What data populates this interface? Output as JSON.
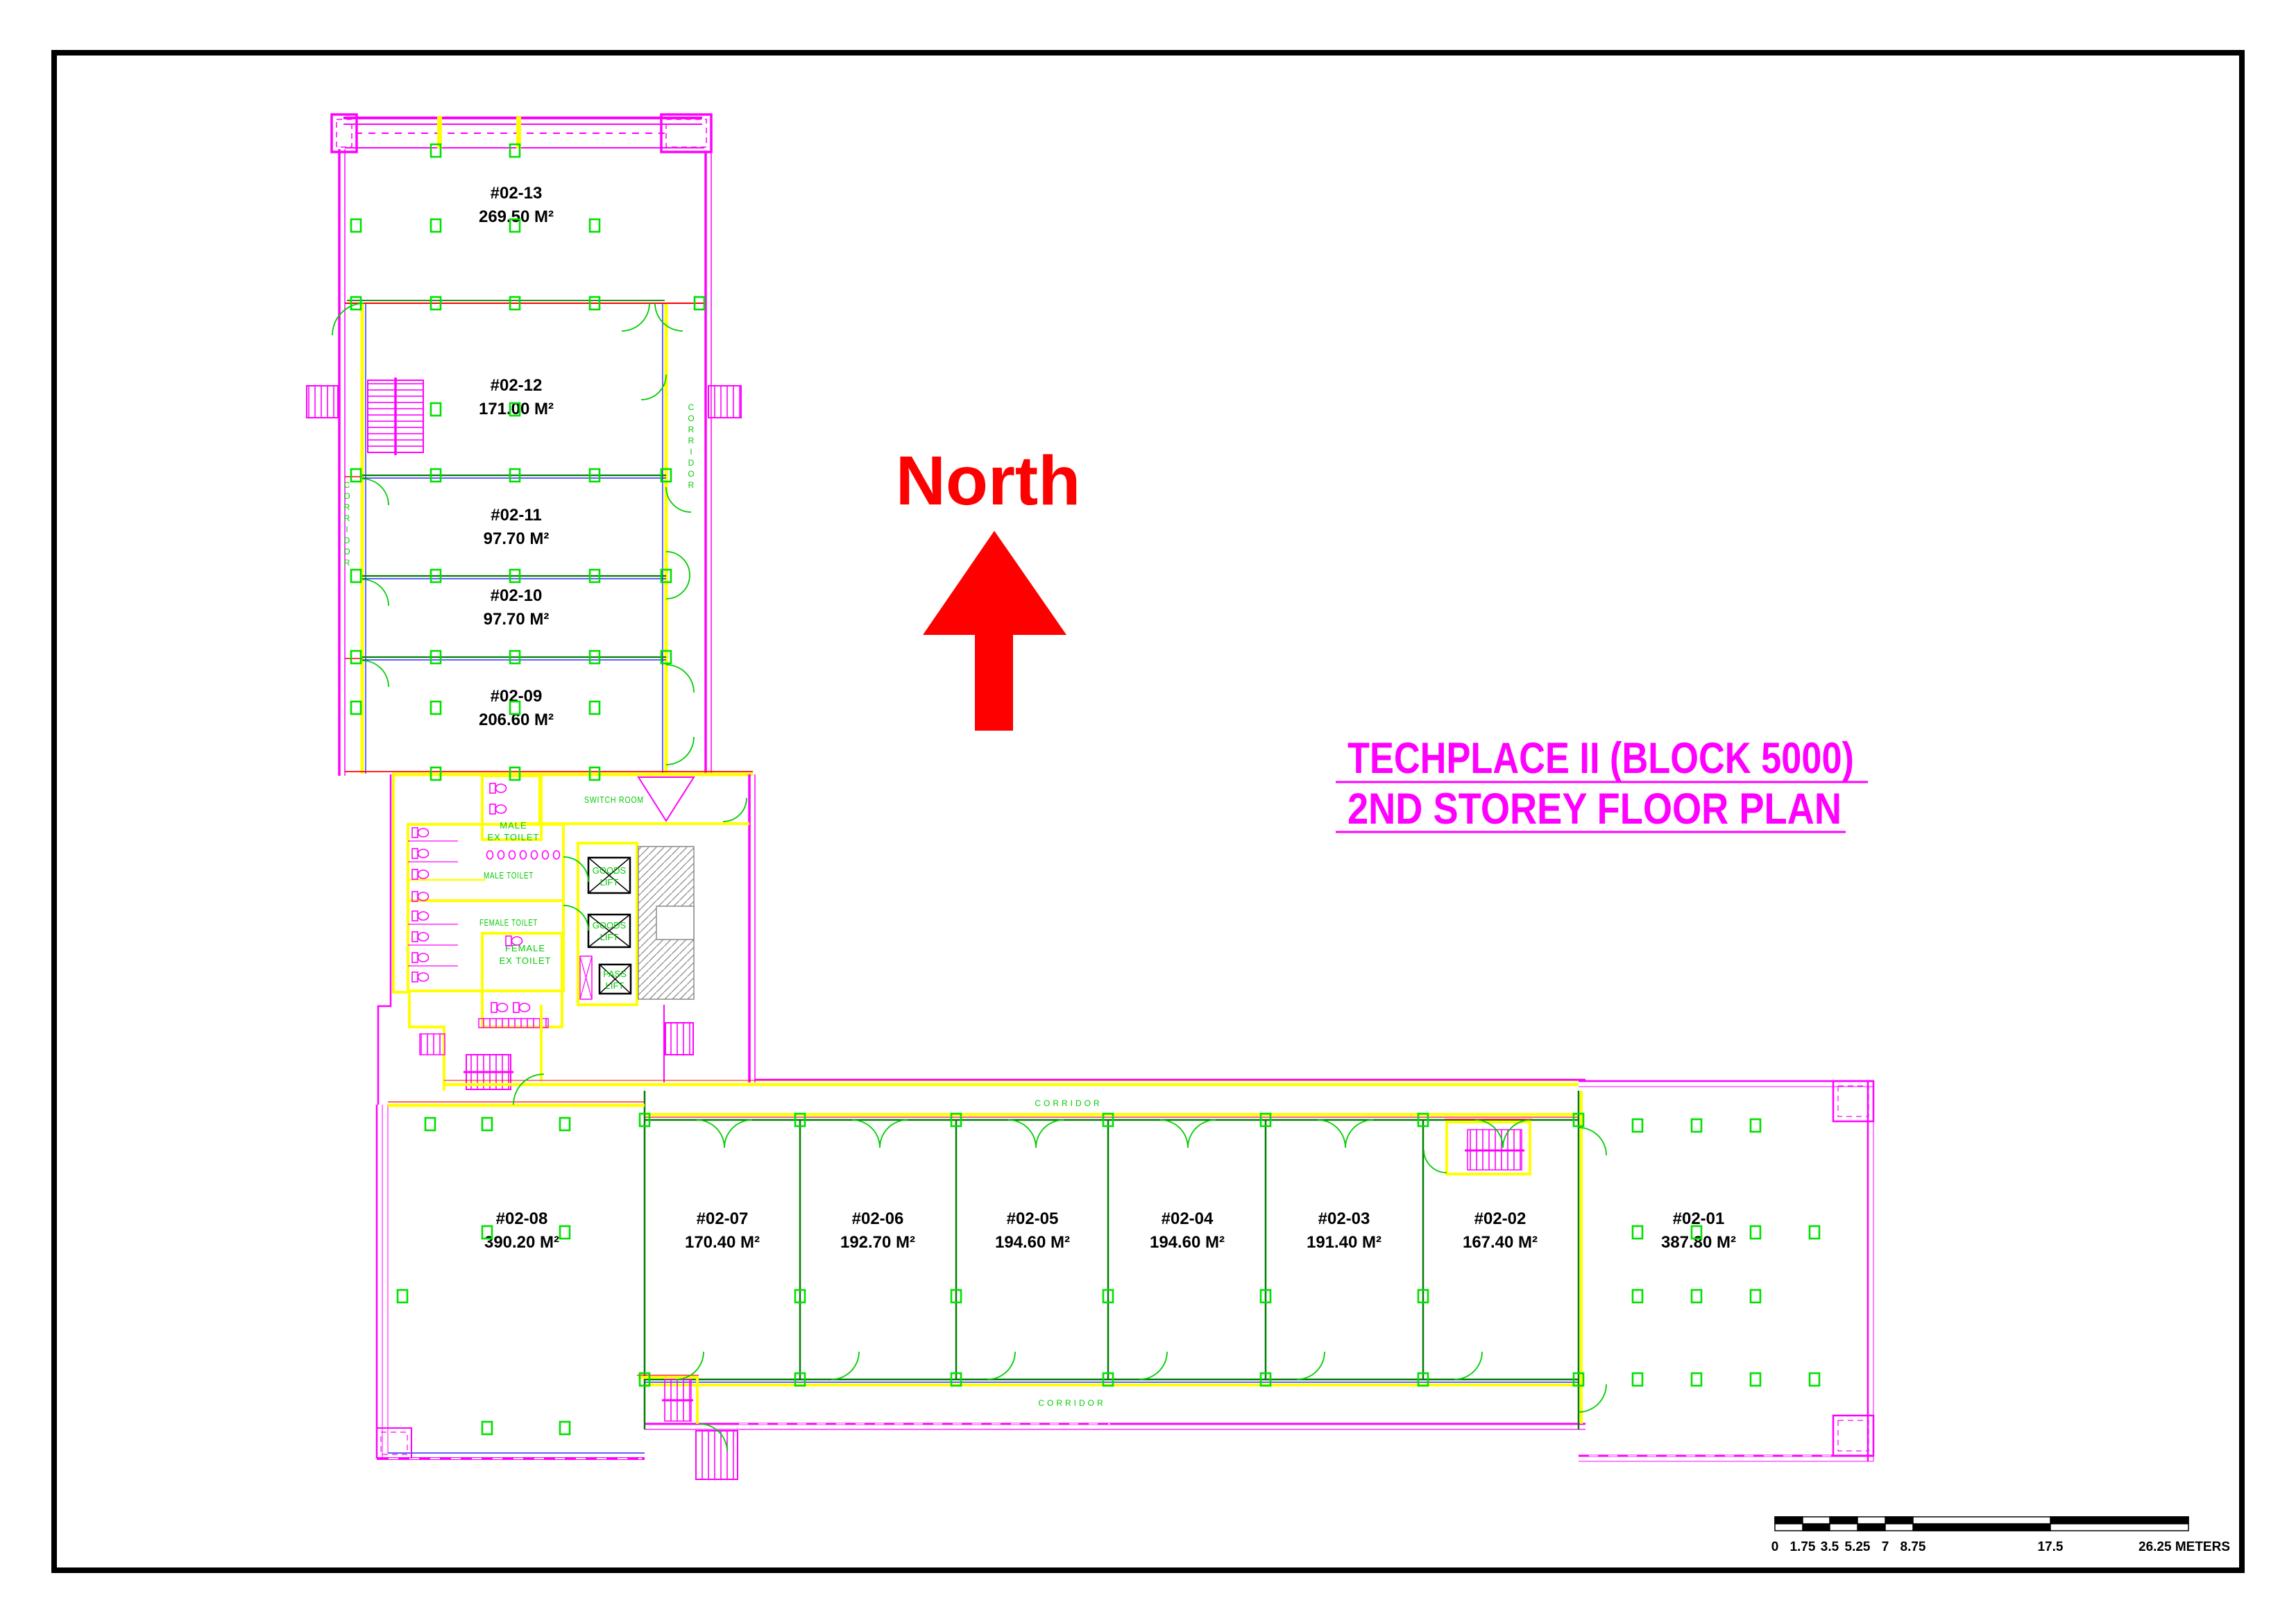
{
  "plan": {
    "title_line1": "TECHPLACE II (BLOCK 5000)",
    "title_line2": "2ND STOREY FLOOR PLAN",
    "north_label": "North"
  },
  "units": [
    {
      "id": "#02-13",
      "area": "269.50 M²"
    },
    {
      "id": "#02-12",
      "area": "171.00 M²"
    },
    {
      "id": "#02-11",
      "area": "97.70 M²"
    },
    {
      "id": "#02-10",
      "area": "97.70 M²"
    },
    {
      "id": "#02-09",
      "area": "206.60 M²"
    },
    {
      "id": "#02-08",
      "area": "390.20 M²"
    },
    {
      "id": "#02-07",
      "area": "170.40 M²"
    },
    {
      "id": "#02-06",
      "area": "192.70 M²"
    },
    {
      "id": "#02-05",
      "area": "194.60 M²"
    },
    {
      "id": "#02-04",
      "area": "194.60 M²"
    },
    {
      "id": "#02-03",
      "area": "191.40 M²"
    },
    {
      "id": "#02-02",
      "area": "167.40 M²"
    },
    {
      "id": "#02-01",
      "area": "387.80 M²"
    }
  ],
  "rooms": {
    "switch_room": "SWITCH ROOM",
    "male_ex_toilet_line1": "MALE",
    "male_ex_toilet_line2": "EX TOILET",
    "male_toilet": "MALE TOILET",
    "female_toilet": "FEMALE TOILET",
    "female_ex_toilet_line1": "FEMALE",
    "female_ex_toilet_line2": "EX TOILET",
    "goods_lift_line1": "GOODS",
    "goods_lift_line2": "LIFT",
    "pass_lift_line1": "PASS",
    "pass_lift_line2": "LIFT"
  },
  "corridor_labels": {
    "top": "CORRIDOR",
    "bottom": "CORRIDOR",
    "left": "CORRIDOR",
    "right": "CORRIDOR"
  },
  "scale_bar": {
    "tick_0": "0",
    "tick_1": "1.75",
    "tick_2": "3.5",
    "tick_3": "5.25",
    "tick_4": "7",
    "tick_5": "8.75",
    "tick_6": "17.5",
    "end_label": "26.25 METERS"
  },
  "colors": {
    "wall_magenta": "#FF00FF",
    "wall_yellow": "#FFFF00",
    "detail_green": "#00E000",
    "divider_green": "#007F00",
    "accent_red": "#FF0000",
    "accent_blue": "#0000FF",
    "north_red": "#FF0000",
    "title_magenta": "#FF00FF",
    "label_black": "#000000"
  }
}
